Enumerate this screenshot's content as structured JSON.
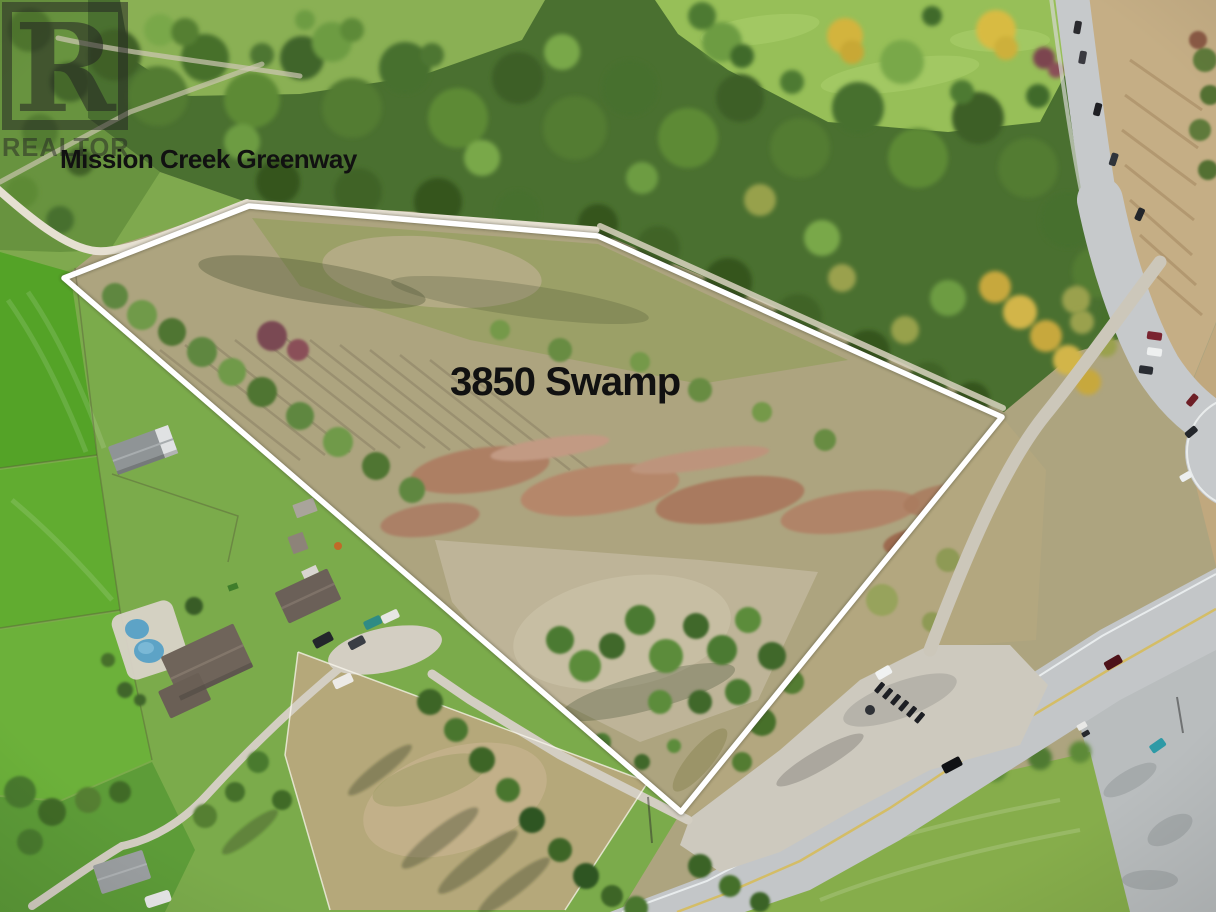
{
  "meta": {
    "type": "aerial-drone-photo",
    "subject": "Real estate listing aerial photo of a vacant rural land parcel outlined in white",
    "canvas": {
      "width": 1216,
      "height": 912
    }
  },
  "labels": {
    "greenway": "Mission Creek Greenway",
    "property": "3850 Swamp"
  },
  "watermark": {
    "letter": "R",
    "word": "REALTOR"
  },
  "scene": {
    "features": [
      "dense forest treeline along Mission Creek Greenway (top)",
      "white surveyed property boundary polygon",
      "dry meadow parcel with reddish brush and pale dirt",
      "highway with partial roundabout (right edge)",
      "paved road with yellow centre line (bottom right)",
      "gravel pull-out and junction with parked vehicles",
      "rural homes with swimming pool, barn, sheds and paddocks (bottom left)",
      "bright green hay fields (left edge)",
      "golf-course green with autumn trees (top right)"
    ],
    "colors": {
      "boundary_line": "#ffffff",
      "label_text": "#111111",
      "watermark": "rgba(35,35,35,0.52)",
      "forest_green": "#4a7030",
      "field_green": "#54a327",
      "lawn_green": "#7bab4b",
      "parcel_ground": "#ada47f",
      "brush_red": "#ad7f63",
      "dirt_pale": "#bfb59a",
      "road_asphalt": "#c3c6c8",
      "gravel": "#cdc9be",
      "trail": "#e6e0d2",
      "pool_water": "#7fb4cc",
      "roof_grey": "#8f9496",
      "roof_brown": "#66594f",
      "autumn_gold": "#c7a83e",
      "centre_line_yellow": "#d9b945"
    }
  }
}
